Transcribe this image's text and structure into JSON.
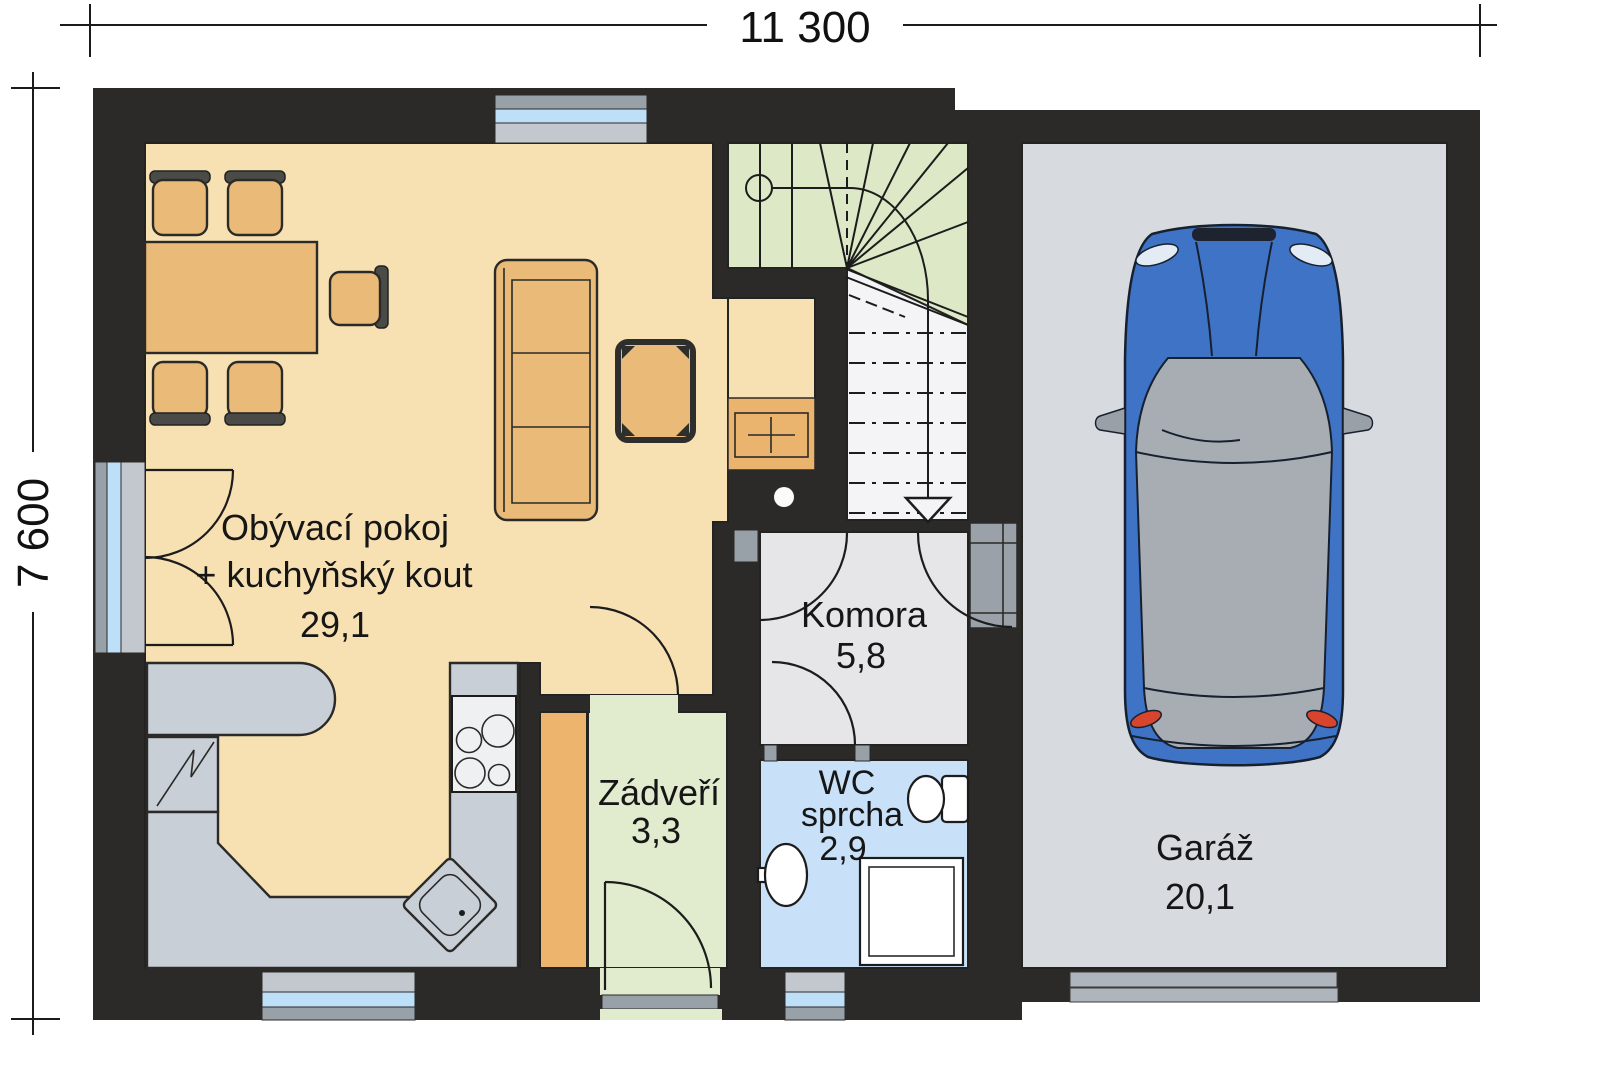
{
  "dimensions": {
    "width_label": "11 300",
    "height_label": "7 600"
  },
  "rooms": {
    "living": {
      "name_line1": "Obývací pokoj",
      "name_line2": "+ kuchyňský kout",
      "area": "29,1"
    },
    "komora": {
      "name": "Komora",
      "area": "5,8"
    },
    "wc": {
      "name_line1": "WC",
      "name_line2": "sprcha",
      "area": "2,9"
    },
    "zadveri": {
      "name": "Zádveří",
      "area": "3,3"
    },
    "garaz": {
      "name": "Garáž",
      "area": "20,1"
    }
  },
  "colors": {
    "walls": "#2b2a28",
    "living": "#f7e1b2",
    "stairs_upper": "#dce8c6",
    "stairs_flight": "#f4f4f6",
    "komora": "#e6e6e8",
    "wc": "#c8e1f8",
    "zadveri": "#e1ecce",
    "wardrobe": "#ecb46c",
    "garage": "#d7dbe0",
    "counter": "#c9cfd6",
    "furniture": "#e9ba78",
    "cabinet": "#eab46e",
    "glass": "#bedff8",
    "car_body": "#3f73c6",
    "car_glass": "#a8adb4",
    "taillight": "#d8452c"
  }
}
